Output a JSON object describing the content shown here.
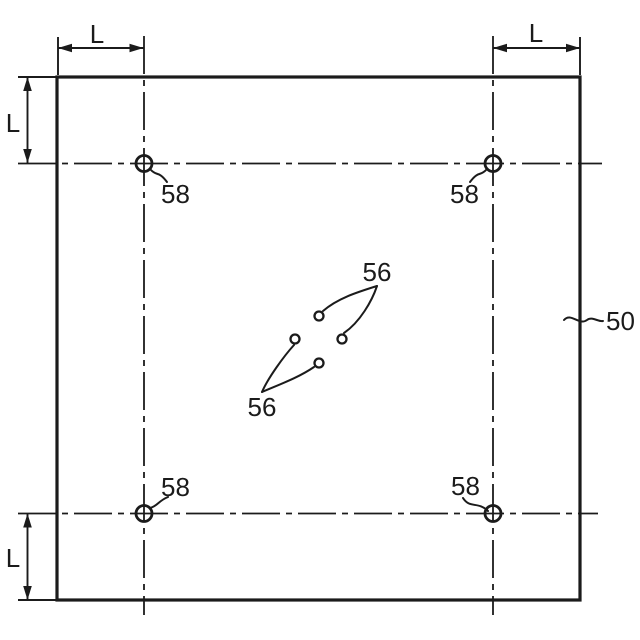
{
  "colors": {
    "ink": "#1b1b1b",
    "background": "#ffffff"
  },
  "diagram": {
    "dimensions": {
      "top_left": "L",
      "top_right": "L",
      "left_upper": "L",
      "left_lower": "L"
    },
    "corner_holes": {
      "top_left": "58",
      "top_right": "58",
      "bottom_left": "58",
      "bottom_right": "58"
    },
    "center_holes": {
      "upper": "56",
      "lower": "56"
    },
    "plate": "50"
  }
}
